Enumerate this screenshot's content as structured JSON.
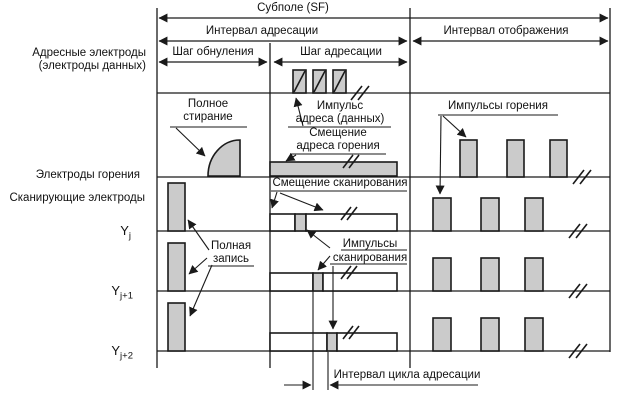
{
  "diagram": {
    "title": "Субполе (SF)",
    "intervals": {
      "addressing": "Интервал адресации",
      "display": "Интервал отображения"
    },
    "steps": {
      "reset": "Шаг обнуления",
      "addressing": "Шаг адресации"
    },
    "electrodes": {
      "address_line1": "Адресные электроды",
      "address_line2": "(электроды данных)",
      "sustain": "Электроды горения",
      "scan": "Сканирующие электроды"
    },
    "rows": {
      "yj": {
        "base": "Y",
        "sub": "j"
      },
      "yj1": {
        "base": "Y",
        "sub": "j+1"
      },
      "yj2": {
        "base": "Y",
        "sub": "j+2"
      }
    },
    "annotations": {
      "full_erase_line1": "Полное",
      "full_erase_line2": "стирание",
      "address_pulse_line1": "Импульс",
      "address_pulse_line2": "адреса (данных)",
      "sustain_bias_line1": "Смещение",
      "sustain_bias_line2": "адреса горения",
      "sustain_pulses": "Импульсы горения",
      "scan_bias": "Смещение сканирования",
      "full_write_line1": "Полная",
      "full_write_line2": "запись",
      "scan_pulses_line1": "Импульсы",
      "scan_pulses_line2": "сканирования",
      "addressing_cycle": "Интервал цикла адресации"
    },
    "colors": {
      "pulse_fill": "#cbcbcb",
      "line": "#1a1a1a",
      "background": "#ffffff"
    }
  }
}
